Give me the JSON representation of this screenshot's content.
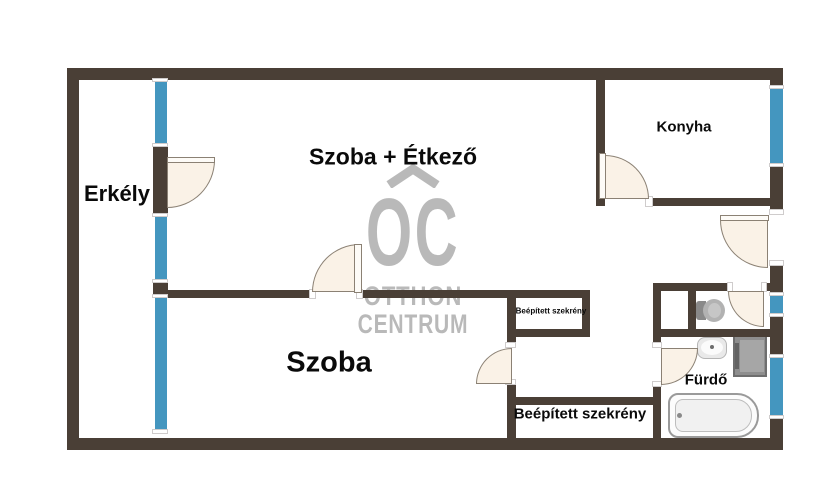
{
  "plan": {
    "rooms": {
      "erkely": {
        "label": "Erkély"
      },
      "szoba_etkezo": {
        "label": "Szoba + Étkező"
      },
      "konyha": {
        "label": "Konyha"
      },
      "szoba": {
        "label": "Szoba"
      },
      "szekreny_small": {
        "label": "Beépített szekrény"
      },
      "szekreny_large": {
        "label": "Beépített szekrény"
      },
      "furdo": {
        "label": "Fürdő"
      }
    },
    "watermark": {
      "monogram": "OC",
      "line1": "OTTHON",
      "line2": "CENTRUM"
    },
    "fixtures": [
      "toilet",
      "sink",
      "washing-machine",
      "bathtub"
    ],
    "colors": {
      "wall": "#4a3f36",
      "window": "#4496bf",
      "door_fill": "#faf2e7",
      "door_stroke": "#8b8174",
      "watermark": "#b9b9b9",
      "background": "#ffffff",
      "label_text": "#0a0a0a"
    }
  }
}
